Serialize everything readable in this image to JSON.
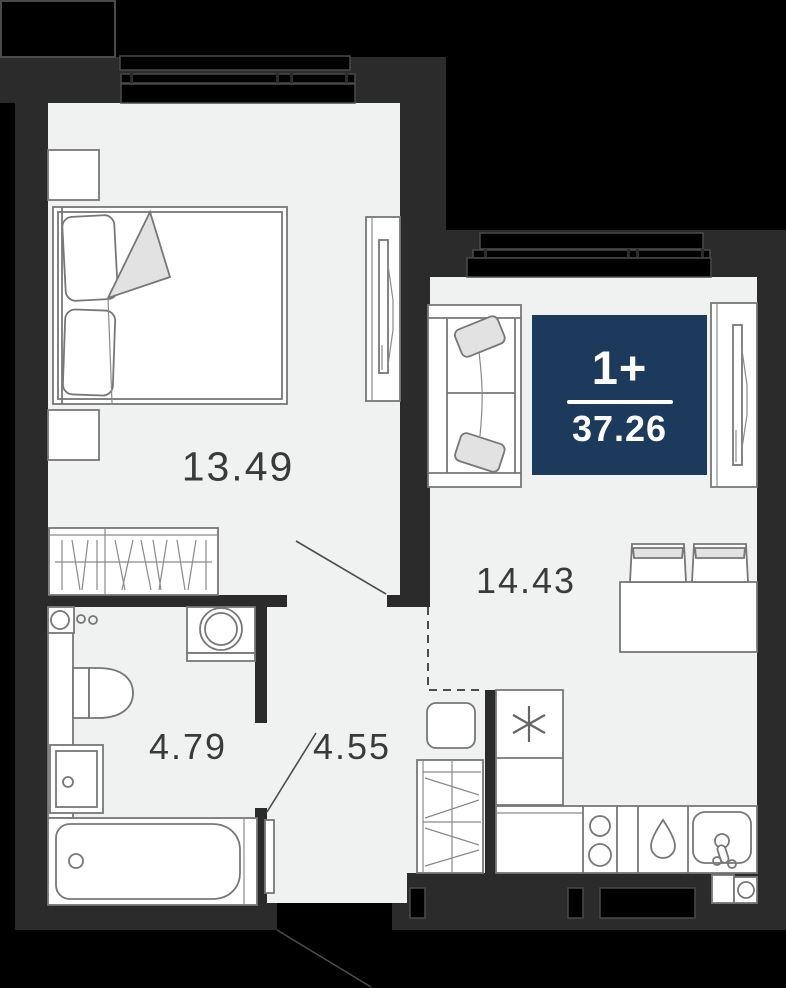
{
  "plan": {
    "badge": {
      "rooms": "1+",
      "total_area": "37.26"
    },
    "rooms": {
      "bedroom": {
        "area": "13.49"
      },
      "living_kitchen": {
        "area": "14.43"
      },
      "bathroom": {
        "area": "4.79"
      },
      "hallway": {
        "area": "4.55"
      }
    },
    "colors": {
      "outside": "#000000",
      "wall": "#2b2b2b",
      "floor": "#f0f1f1",
      "furniture_fill": "#ffffff",
      "furniture_stroke": "#777777",
      "soft_fill": "#e2e2e2",
      "badge_bg": "#1c3a5c",
      "badge_text": "#ffffff",
      "label_text": "#3a3a3a"
    }
  }
}
